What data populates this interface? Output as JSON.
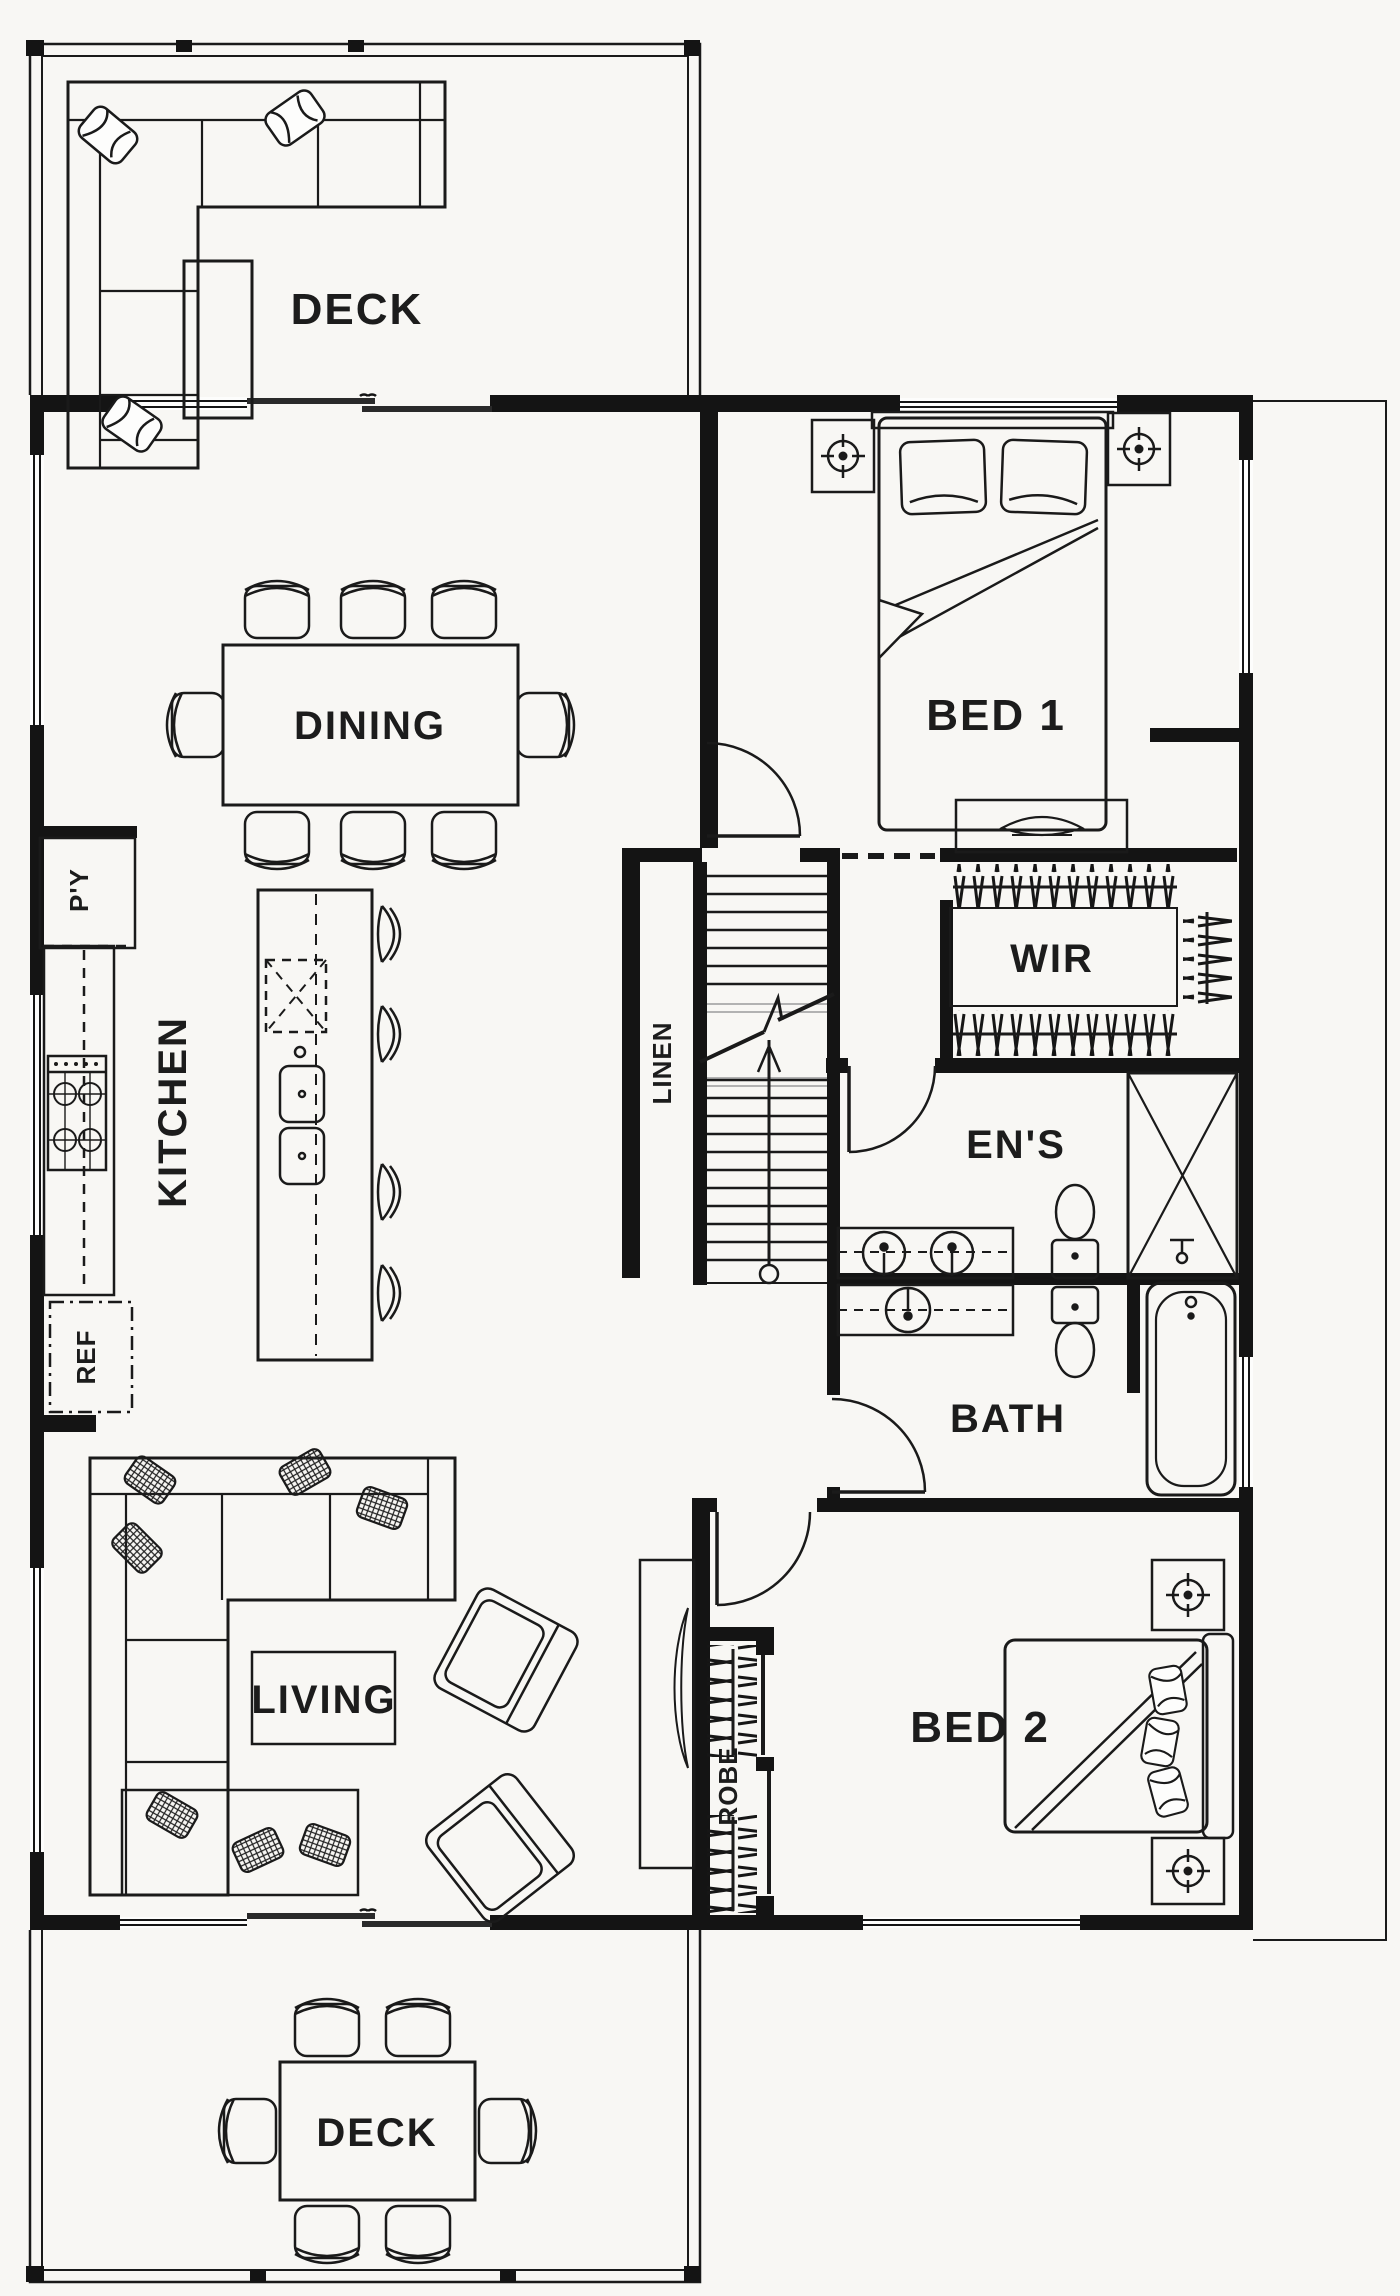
{
  "plan": {
    "title": "Floor plan",
    "labels": {
      "deck_top": "DECK",
      "dining": "DINING",
      "kitchen": "KITCHEN",
      "pantry": "P'Y",
      "fridge": "REF",
      "bed1": "BED 1",
      "wir": "WIR",
      "linen": "LINEN",
      "ensuite": "EN'S",
      "bath": "BATH",
      "living": "LIVING",
      "bed2": "BED 2",
      "robe": "ROBE",
      "deck_bottom": "DECK"
    },
    "colors": {
      "ink": "#1a1a1a",
      "wall": "#141414",
      "paper": "#f8f7f4"
    }
  }
}
